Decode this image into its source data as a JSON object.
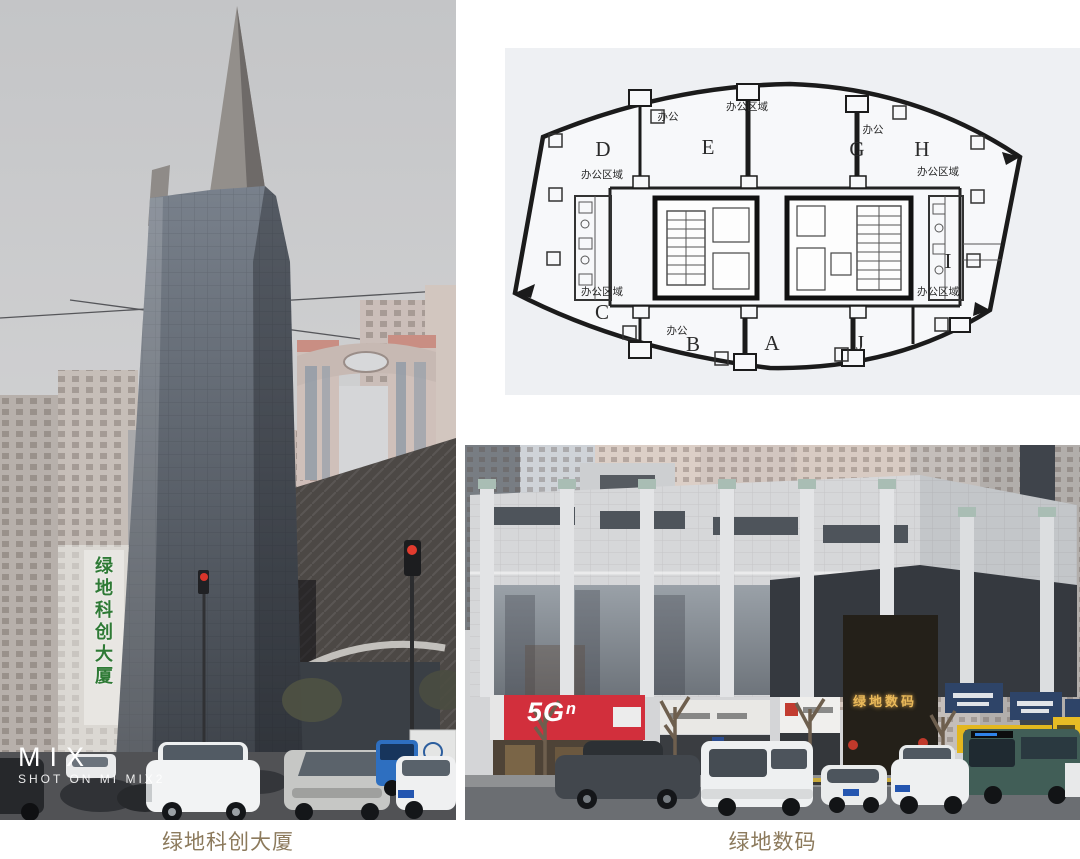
{
  "captions": {
    "left": "绿地科创大厦",
    "right": "绿地数码"
  },
  "left_photo": {
    "watermark_brand": "MIX",
    "watermark_sub": "SHOT ON MI MIX2",
    "tower_sign_vertical": "绿地科创大厦"
  },
  "floorplan": {
    "units": [
      "D",
      "E",
      "G",
      "H",
      "C",
      "B",
      "A",
      "J",
      "I"
    ],
    "area_label": "办公区域",
    "office_label": "办公"
  },
  "right_photo": {
    "telecom_sign": "5Gⁿ",
    "entrance_sign": "绿地数码"
  },
  "colors": {
    "caption_text": "#8c7a5c",
    "tower_sign_green": "#2e7a35",
    "telecom_sign_red": "#d22f3c",
    "entrance_sign_gold": "#e9b95a",
    "blue_sign": "#2e4468",
    "yellow_sign": "#e3b71e"
  }
}
